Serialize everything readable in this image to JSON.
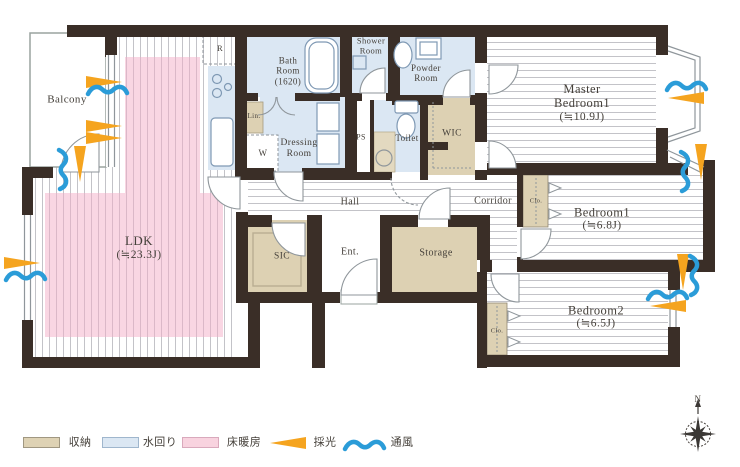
{
  "rooms": {
    "balcony": {
      "name": "Balcony"
    },
    "ldk": {
      "name": "LDK",
      "size": "(≒23.3J)"
    },
    "kitchen": {
      "fridge": "R"
    },
    "bath": {
      "l1": "Bath",
      "l2": "Room",
      "l3": "(1620)"
    },
    "shower": {
      "l1": "Shower",
      "l2": "Room"
    },
    "powder": {
      "l1": "Powder",
      "l2": "Room"
    },
    "dressing": {
      "l1": "Dressing",
      "l2": "Room"
    },
    "linen": {
      "name": "Lin."
    },
    "washer": {
      "name": "W"
    },
    "ps": {
      "name": "PS"
    },
    "toilet": {
      "name": "Toilet"
    },
    "wic": {
      "name": "WIC"
    },
    "master": {
      "l1": "Master",
      "l2": "Bedroom1",
      "size": "(≒10.9J)"
    },
    "hall": {
      "name": "Hall"
    },
    "corridor": {
      "name": "Corridor"
    },
    "bedroom1": {
      "name": "Bedroom1",
      "size": "(≒6.8J)",
      "closet": "Clo."
    },
    "bedroom2": {
      "name": "Bedroom2",
      "size": "(≒6.5J)",
      "closet": "Clo."
    },
    "sic": {
      "name": "SIC"
    },
    "entrance": {
      "name": "Ent."
    },
    "storage": {
      "name": "Storage"
    }
  },
  "legend": {
    "storage_label": "収納",
    "water_label": "水回り",
    "floor_heating_label": "床暖房",
    "daylight_label": "採光",
    "ventilation_label": "通風"
  },
  "compass": {
    "north": "N"
  },
  "colors": {
    "wall": "#3a2e27",
    "water_rooms": "#dbe7f3",
    "storage_areas": "#ddd1b3",
    "floor_heating": "#f6cdde",
    "daylight": "#f5a41f",
    "ventilation": "#2b9cd8"
  }
}
